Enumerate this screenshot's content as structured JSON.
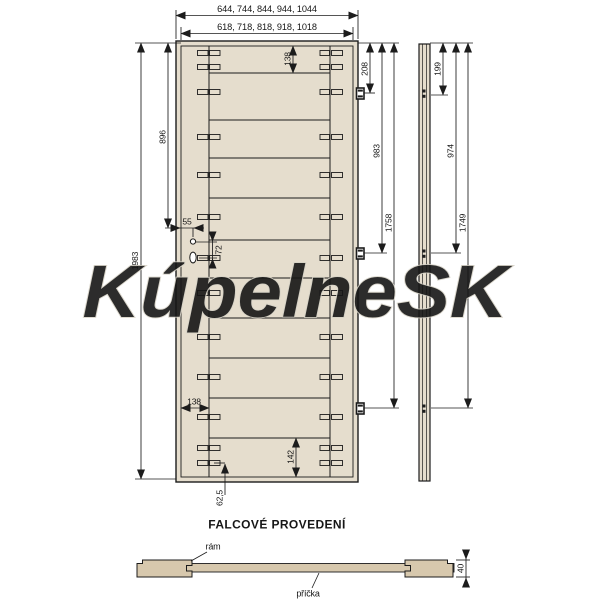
{
  "watermark": "KúpelneSK",
  "section_title": "FALCOVÉ PROVEDENÍ",
  "colors": {
    "door_fill": "#e5ddcd",
    "wood_fill": "#d7c8ad",
    "line": "#1c1c1c",
    "watermark_stroke": "#d6d2c6",
    "watermark_fill": "rgba(255,255,255,0.55)"
  },
  "front_view": {
    "width_outer_label": "644, 744, 844, 944, 1044",
    "width_inner_label": "618, 718, 818, 918, 1018",
    "height_label": "1983",
    "lock_height_label": "896",
    "lock_offset_label": "55",
    "lock_spacing_label": "72",
    "top_rail_label": "138",
    "side_rail_label": "138",
    "bottom_rail_label": "142",
    "bottom_slot_label": "62,5",
    "hinge1_label": "208",
    "hinge2_label": "983",
    "hinge3_label": "1758",
    "plank_line_ys": [
      73,
      120,
      158,
      198,
      240,
      278,
      318,
      358,
      398,
      438
    ],
    "slot_ys": [
      53,
      67,
      92,
      137,
      175,
      217,
      258,
      293,
      337,
      377,
      417,
      448,
      463
    ],
    "hinge_ys": [
      88,
      248,
      403
    ]
  },
  "side_view": {
    "hinge1_label": "199",
    "hinge2_label": "974",
    "hinge3_label": "1749",
    "hinge_ys": [
      88,
      248,
      403
    ]
  },
  "cross_section": {
    "frame_label": "rám",
    "panel_label": "příčka",
    "thickness_label": "40"
  }
}
